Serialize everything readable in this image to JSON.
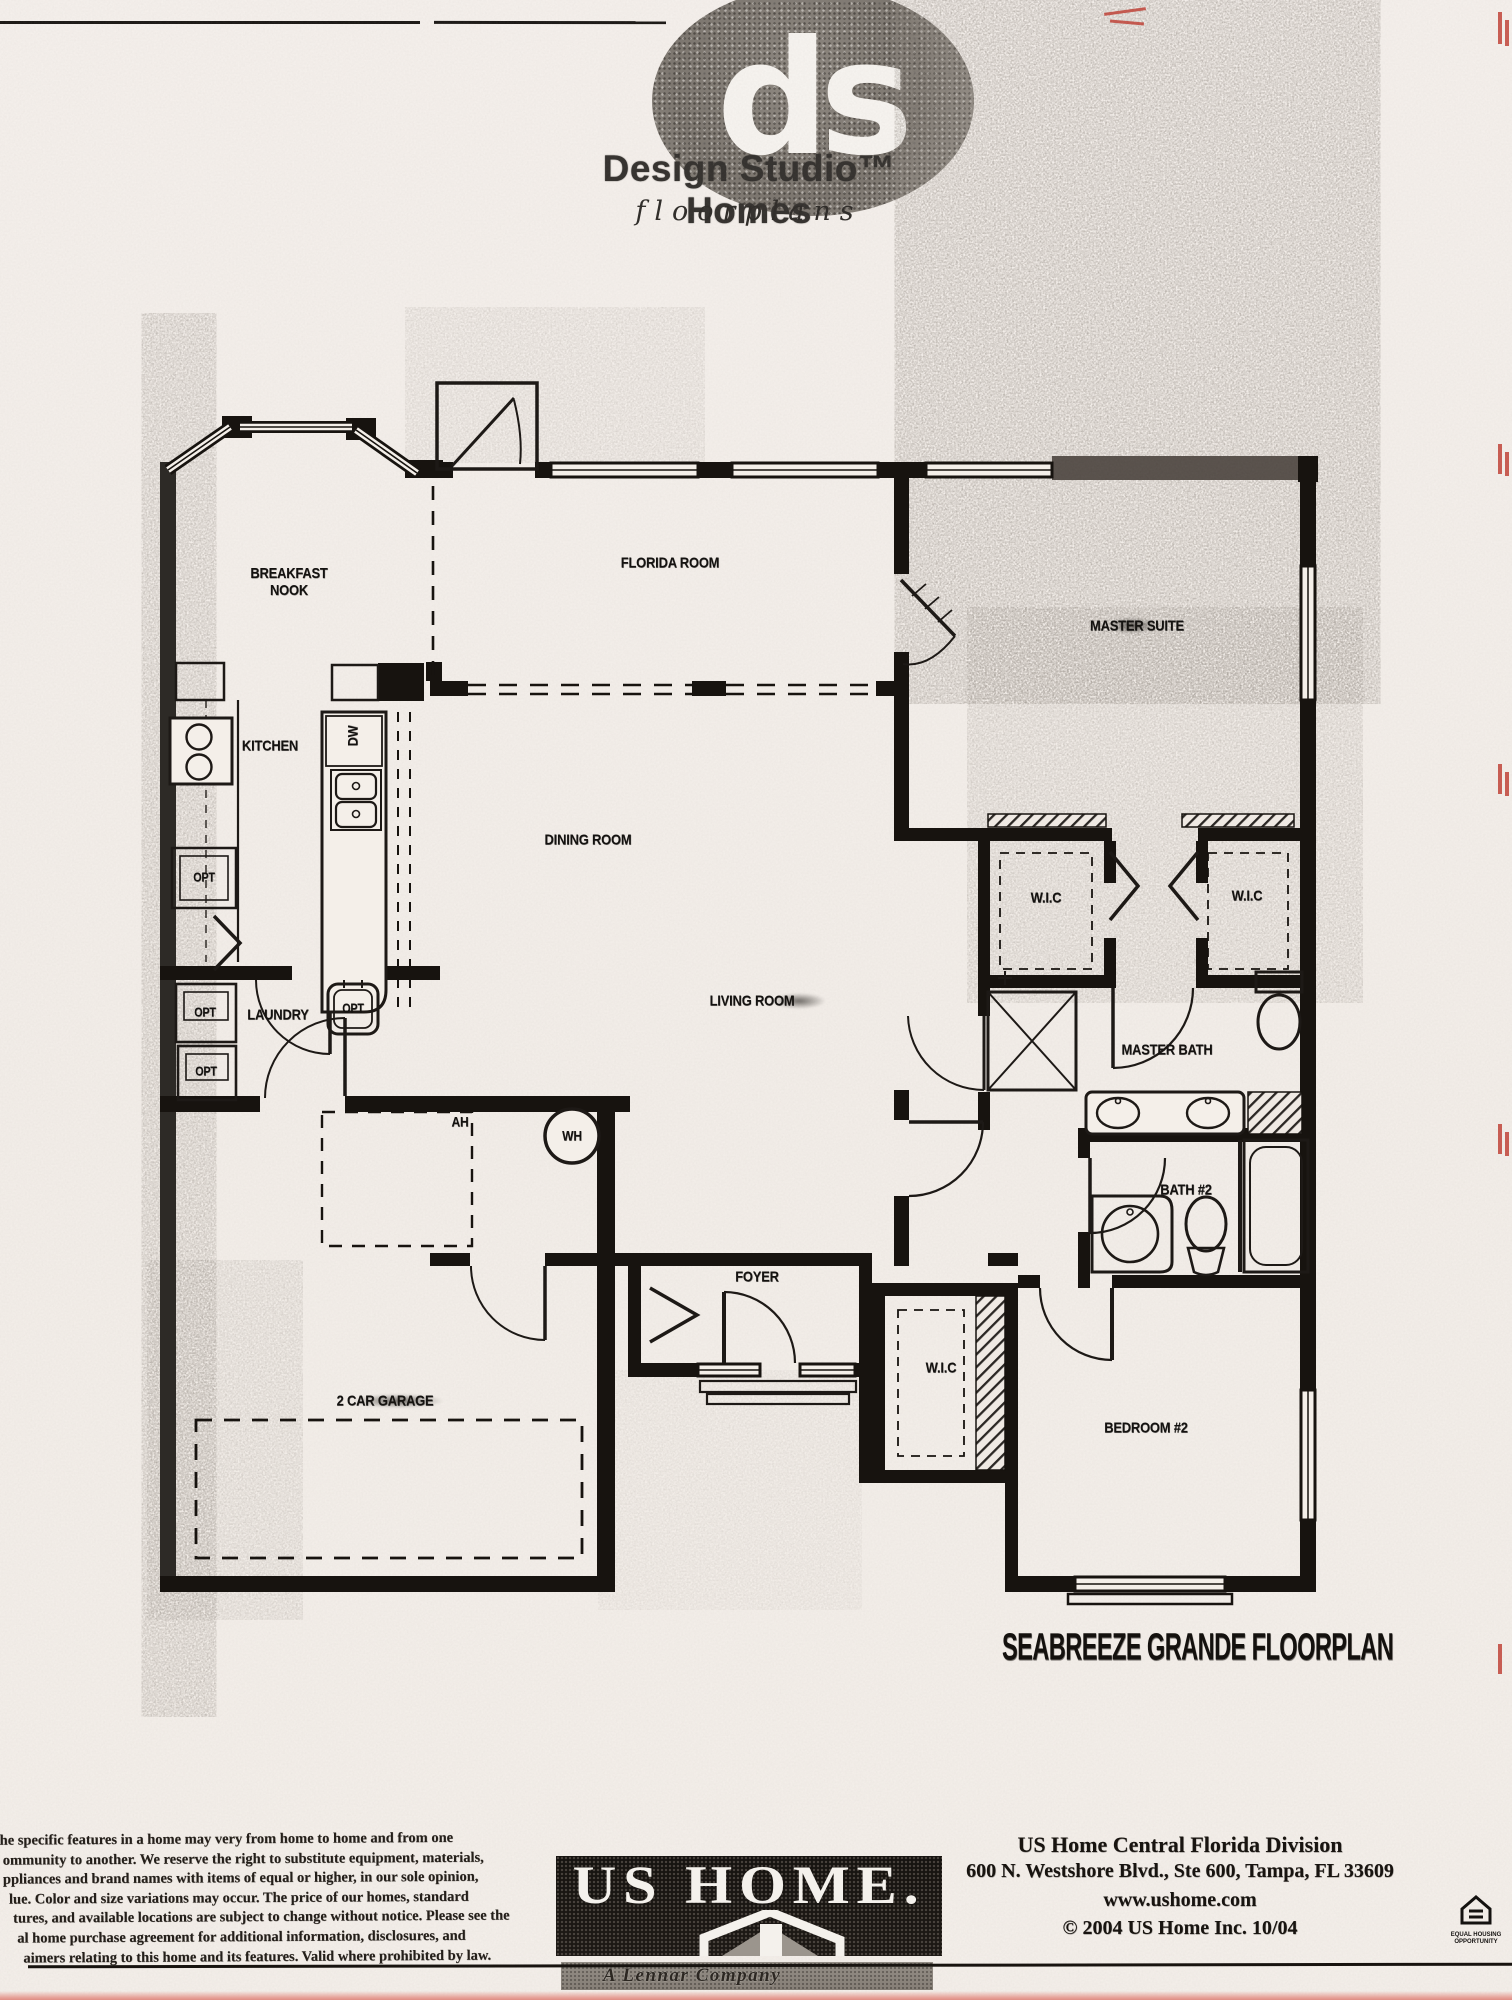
{
  "logo": {
    "monogram": "ds",
    "brand": "Design Studio™ Homes",
    "subtitle": "floorplans"
  },
  "floorplan": {
    "title": "SEABREEZE GRANDE FLOORPLAN",
    "labels": {
      "breakfast_nook": "BREAKFAST\nNOOK",
      "florida_room": "FLORIDA ROOM",
      "master_suite": "MASTER SUITE",
      "kitchen": "KITCHEN",
      "dishwasher": "DW",
      "dining_room": "DINING ROOM",
      "wic": "W.I.C",
      "laundry": "LAUNDRY",
      "living_room": "LIVING ROOM",
      "master_bath": "MASTER BATH",
      "opt": "OPT",
      "air_handler": "AH",
      "water_heater": "WH",
      "bath_2": "BATH #2",
      "foyer": "FOYER",
      "garage": "2 CAR GARAGE",
      "bedroom_2": "BEDROOM #2"
    }
  },
  "footer": {
    "disclaimer_lines": [
      "he specific features in a home may very from home to home and from one",
      "ommunity to another. We reserve the right to substitute equipment, materials,",
      "ppliances and brand names with items of equal or higher, in our sole opinion,",
      "lue. Color and size variations may occur. The price of our homes, standard",
      "tures, and available locations are subject to change without notice. Please see the",
      "al home purchase agreement for additional information, disclosures, and",
      "aimers relating to this home and its features. Valid where prohibited by law."
    ],
    "ushome": {
      "name": "US HOME.",
      "tagline": "A Lennar Company"
    },
    "address": {
      "line1": "US Home Central Florida Division",
      "line2": "600 N. Westshore Blvd., Ste 600, Tampa, FL 33609",
      "line3": "www.ushome.com",
      "line4": "© 2004 US Home Inc. 10/04"
    },
    "eho_label": "EQUAL HOUSING\nOPPORTUNITY"
  }
}
